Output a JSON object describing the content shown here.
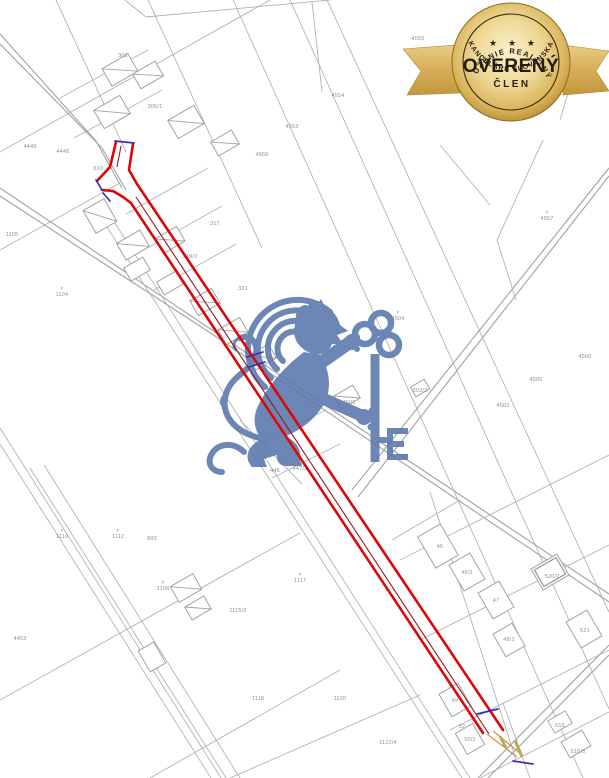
{
  "page": {
    "width": 609,
    "height": 778,
    "background": "#ffffff"
  },
  "badge": {
    "top_arc": "ZDRUŽENIE REALITNÝCH",
    "stars": "★ ★ ★",
    "title": "OVERENÝ",
    "subtitle": "ČLEN",
    "bottom_arc": "KANCELÁRIÍ SLOVENSKA"
  },
  "watermark": {
    "icon": "lion-holding-key-logo",
    "color": "#5d7aad"
  },
  "colors": {
    "map_line": "#b3b3b3",
    "road_line": "#a7a7a7",
    "building": "#a3a3a3",
    "label": "#8f8f8f",
    "parcel_red": "#de0606",
    "parcel_inner": "#8b1d25",
    "mark_blue": "#3d2eb8",
    "tan": "#c8842f",
    "olive": "#b5ab5e",
    "gold_light": "#f9efc9",
    "gold_mid": "#e2c36f",
    "gold_dark": "#b3872c",
    "gold_edge": "#8f6d1d",
    "ribbon_light": "#e3c075",
    "ribbon_dark": "#c49a3e",
    "badge_text": "#2b2013"
  },
  "map": {
    "label_prefix": "F",
    "lines": [
      [
        233,
        0,
        583,
        778
      ],
      [
        327,
        0,
        609,
        612
      ],
      [
        290,
        0,
        609,
        709
      ],
      [
        148,
        0,
        262,
        248
      ],
      [
        56,
        0,
        126,
        152
      ],
      [
        125,
        0,
        146,
        17
      ],
      [
        146,
        17,
        330,
        0
      ],
      [
        312,
        2,
        322,
        92
      ],
      [
        0,
        152,
        270,
        0
      ],
      [
        0,
        250,
        120,
        183
      ],
      [
        60,
        98,
        148,
        50
      ],
      [
        74,
        138,
        162,
        90
      ],
      [
        126,
        214,
        208,
        168
      ],
      [
        140,
        252,
        222,
        206
      ],
      [
        154,
        290,
        236,
        244
      ],
      [
        0,
        34,
        96,
        141,
        1.2
      ],
      [
        0,
        44,
        102,
        148,
        1.2
      ],
      [
        96,
        141,
        122,
        188,
        1.2
      ],
      [
        102,
        148,
        126,
        190,
        1.2
      ],
      [
        0,
        188,
        200,
        322,
        1.2
      ],
      [
        200,
        322,
        609,
        594,
        1.2
      ],
      [
        0,
        196,
        206,
        330,
        1.2
      ],
      [
        206,
        330,
        609,
        602,
        1.2
      ],
      [
        96,
        210,
        462,
        778
      ],
      [
        104,
        206,
        470,
        778
      ],
      [
        0,
        428,
        221,
        778
      ],
      [
        0,
        444,
        211,
        778
      ],
      [
        30,
        468,
        226,
        778
      ],
      [
        44,
        465,
        240,
        778
      ],
      [
        0,
        700,
        300,
        533
      ],
      [
        150,
        778,
        340,
        670
      ],
      [
        258,
        444,
        326,
        410
      ],
      [
        272,
        478,
        340,
        444
      ],
      [
        240,
        420,
        302,
        484
      ],
      [
        352,
        490,
        609,
        168,
        1.2
      ],
      [
        358,
        497,
        609,
        176,
        1.2
      ],
      [
        440,
        145,
        490,
        205
      ],
      [
        543,
        140,
        497,
        240
      ],
      [
        497,
        240,
        516,
        300
      ],
      [
        400,
        560,
        609,
        455
      ],
      [
        420,
        640,
        609,
        545
      ],
      [
        450,
        730,
        609,
        650
      ],
      [
        480,
        778,
        609,
        712
      ],
      [
        478,
        778,
        609,
        645,
        1.2
      ],
      [
        488,
        778,
        609,
        655,
        1.2
      ],
      [
        430,
        492,
        516,
        760
      ],
      [
        392,
        540,
        460,
        500
      ],
      [
        230,
        778,
        420,
        695
      ],
      [
        503,
        703,
        530,
        778
      ],
      [
        520,
        10,
        575,
        70
      ],
      [
        575,
        70,
        560,
        120
      ]
    ],
    "buildings": [
      [
        120,
        70,
        30,
        20,
        "house"
      ],
      [
        148,
        75,
        26,
        17,
        "house"
      ],
      [
        112,
        112,
        30,
        21,
        "house"
      ],
      [
        186,
        122,
        30,
        21,
        "house"
      ],
      [
        225,
        143,
        24,
        16,
        "house"
      ],
      [
        100,
        216,
        24,
        26,
        "house"
      ],
      [
        133,
        245,
        27,
        19,
        "house"
      ],
      [
        137,
        269,
        22,
        15,
        "rect"
      ],
      [
        170,
        240,
        25,
        17,
        "house"
      ],
      [
        170,
        283,
        22,
        15,
        "rect"
      ],
      [
        205,
        302,
        25,
        17,
        "house"
      ],
      [
        233,
        331,
        25,
        17,
        "house"
      ],
      [
        262,
        357,
        24,
        16,
        "house"
      ],
      [
        347,
        397,
        22,
        15,
        "house"
      ],
      [
        420,
        388,
        16,
        11,
        "rect"
      ],
      [
        438,
        546,
        26,
        36,
        "rect"
      ],
      [
        467,
        572,
        24,
        30,
        "rect"
      ],
      [
        496,
        600,
        24,
        30,
        "rect"
      ],
      [
        509,
        640,
        22,
        26,
        "rect"
      ],
      [
        550,
        572,
        30,
        24,
        "bold"
      ],
      [
        584,
        629,
        24,
        30,
        "rect"
      ],
      [
        455,
        700,
        22,
        26,
        "rect"
      ],
      [
        470,
        739,
        20,
        24,
        "rect"
      ],
      [
        560,
        722,
        20,
        14,
        "rect"
      ],
      [
        576,
        744,
        24,
        18,
        "rect"
      ],
      [
        186,
        588,
        26,
        18,
        "house"
      ],
      [
        198,
        608,
        22,
        15,
        "house"
      ],
      [
        152,
        657,
        18,
        24,
        "rect"
      ]
    ],
    "labels": [
      [
        30,
        148,
        "4449",
        0
      ],
      [
        63,
        153,
        "4445",
        0
      ],
      [
        292,
        128,
        "4553",
        0
      ],
      [
        262,
        156,
        "4550",
        0
      ],
      [
        338,
        97,
        "4554",
        0
      ],
      [
        418,
        40,
        "4555",
        0
      ],
      [
        547,
        220,
        "4557",
        1
      ],
      [
        585,
        358,
        "4560",
        0
      ],
      [
        503,
        407,
        "4502",
        0
      ],
      [
        536,
        381,
        "4505",
        0
      ],
      [
        398,
        320,
        "4504",
        1
      ],
      [
        62,
        296,
        "1104",
        1
      ],
      [
        12,
        236,
        "1105",
        0
      ],
      [
        123,
        57,
        "302",
        0
      ],
      [
        155,
        108,
        "305/1",
        0
      ],
      [
        98,
        170,
        "310",
        0
      ],
      [
        215,
        225,
        "317",
        0
      ],
      [
        190,
        258,
        "319/2",
        0
      ],
      [
        243,
        290,
        "321",
        0
      ],
      [
        349,
        404,
        "4501",
        0
      ],
      [
        420,
        392,
        "503/2",
        0
      ],
      [
        62,
        538,
        "1110",
        1
      ],
      [
        118,
        538,
        "1112",
        1
      ],
      [
        20,
        640,
        "4453",
        0
      ],
      [
        152,
        540,
        "893",
        0
      ],
      [
        163,
        590,
        "1108",
        1
      ],
      [
        238,
        612,
        "1115/2",
        0
      ],
      [
        300,
        582,
        "1117",
        1
      ],
      [
        275,
        472,
        "446",
        0
      ],
      [
        300,
        470,
        "447/2",
        0
      ],
      [
        440,
        548,
        "45",
        0
      ],
      [
        467,
        574,
        "46/2",
        0
      ],
      [
        496,
        602,
        "47",
        0
      ],
      [
        509,
        641,
        "48/1",
        0
      ],
      [
        552,
        578,
        "520/2",
        0
      ],
      [
        585,
        632,
        "521",
        0
      ],
      [
        455,
        702,
        "49",
        0
      ],
      [
        470,
        741,
        "50/2",
        0
      ],
      [
        560,
        727,
        "515",
        0
      ],
      [
        578,
        753,
        "516/3",
        0
      ],
      [
        462,
        728,
        "52",
        0
      ],
      [
        388,
        744,
        "1122/4",
        0
      ],
      [
        340,
        700,
        "1120",
        0
      ],
      [
        258,
        700,
        "1118",
        0
      ]
    ],
    "subject_parcel": {
      "red_polylines": [
        [
          [
            116,
            142
          ],
          [
            110,
            167
          ],
          [
            97,
            181
          ]
        ],
        [
          [
            133,
            144
          ],
          [
            129,
            170
          ],
          [
            137,
            184
          ],
          [
            503,
            730
          ]
        ],
        [
          [
            102,
            190
          ],
          [
            113,
            191
          ],
          [
            123,
            197
          ],
          [
            131,
            203
          ],
          [
            483,
            733
          ]
        ]
      ],
      "inner_lines": [
        [
          [
            136,
            197
          ],
          [
            489,
            734
          ]
        ],
        [
          [
            121,
            146
          ],
          [
            117,
            167
          ]
        ]
      ],
      "blue_segments": [
        [
          [
            115,
            141
          ],
          [
            134,
            143
          ]
        ],
        [
          [
            96,
            180
          ],
          [
            102,
            190
          ]
        ],
        [
          [
            103,
            193
          ],
          [
            110,
            201
          ]
        ],
        [
          [
            247,
            357
          ],
          [
            263,
            352
          ]
        ],
        [
          [
            249,
            367
          ],
          [
            265,
            362
          ]
        ],
        [
          [
            477,
            714
          ],
          [
            498,
            709
          ]
        ],
        [
          [
            513,
            761
          ],
          [
            533,
            764
          ]
        ]
      ],
      "tan_lines": [
        [
          [
            487,
            734
          ],
          [
            517,
            757
          ]
        ],
        [
          [
            493,
            731
          ],
          [
            521,
            754
          ]
        ]
      ],
      "olive_bars": [
        [
          [
            500,
            736
          ],
          [
            506,
            748
          ]
        ],
        [
          [
            515,
            740
          ],
          [
            522,
            757
          ]
        ]
      ]
    }
  }
}
